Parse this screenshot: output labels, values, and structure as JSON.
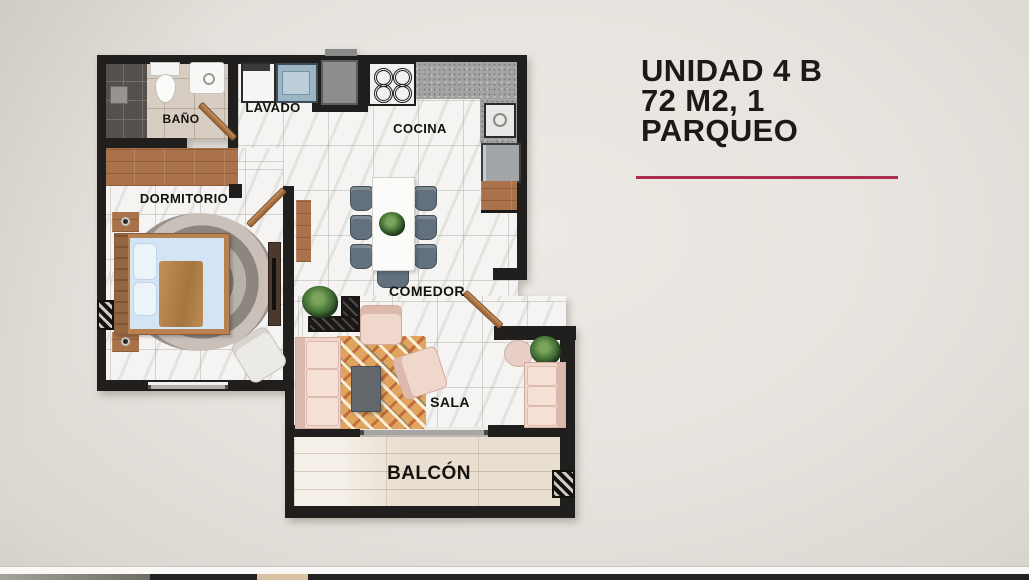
{
  "unit_title": {
    "lines": [
      "UNIDAD 4 B",
      "72 M2, 1",
      "PARQUEO"
    ]
  },
  "divider": {
    "color": "#ac2e4e"
  },
  "palette": {
    "background": "#e7e3de",
    "wall": "#211f1d",
    "marble_floor": "#f5f4f2",
    "wood": "#a9724a",
    "sofa_pink": "#f0d7cc",
    "chair_slate": "#62717d",
    "rug_orange": "#e0a45f"
  },
  "floorplan": {
    "labels": {
      "bathroom": "BAÑO",
      "laundry": "LAVADO",
      "kitchen": "COCINA",
      "bedroom": "DORMITORIO",
      "dining": "COMEDOR",
      "living": "SALA",
      "balcony": "BALCÓN"
    }
  }
}
